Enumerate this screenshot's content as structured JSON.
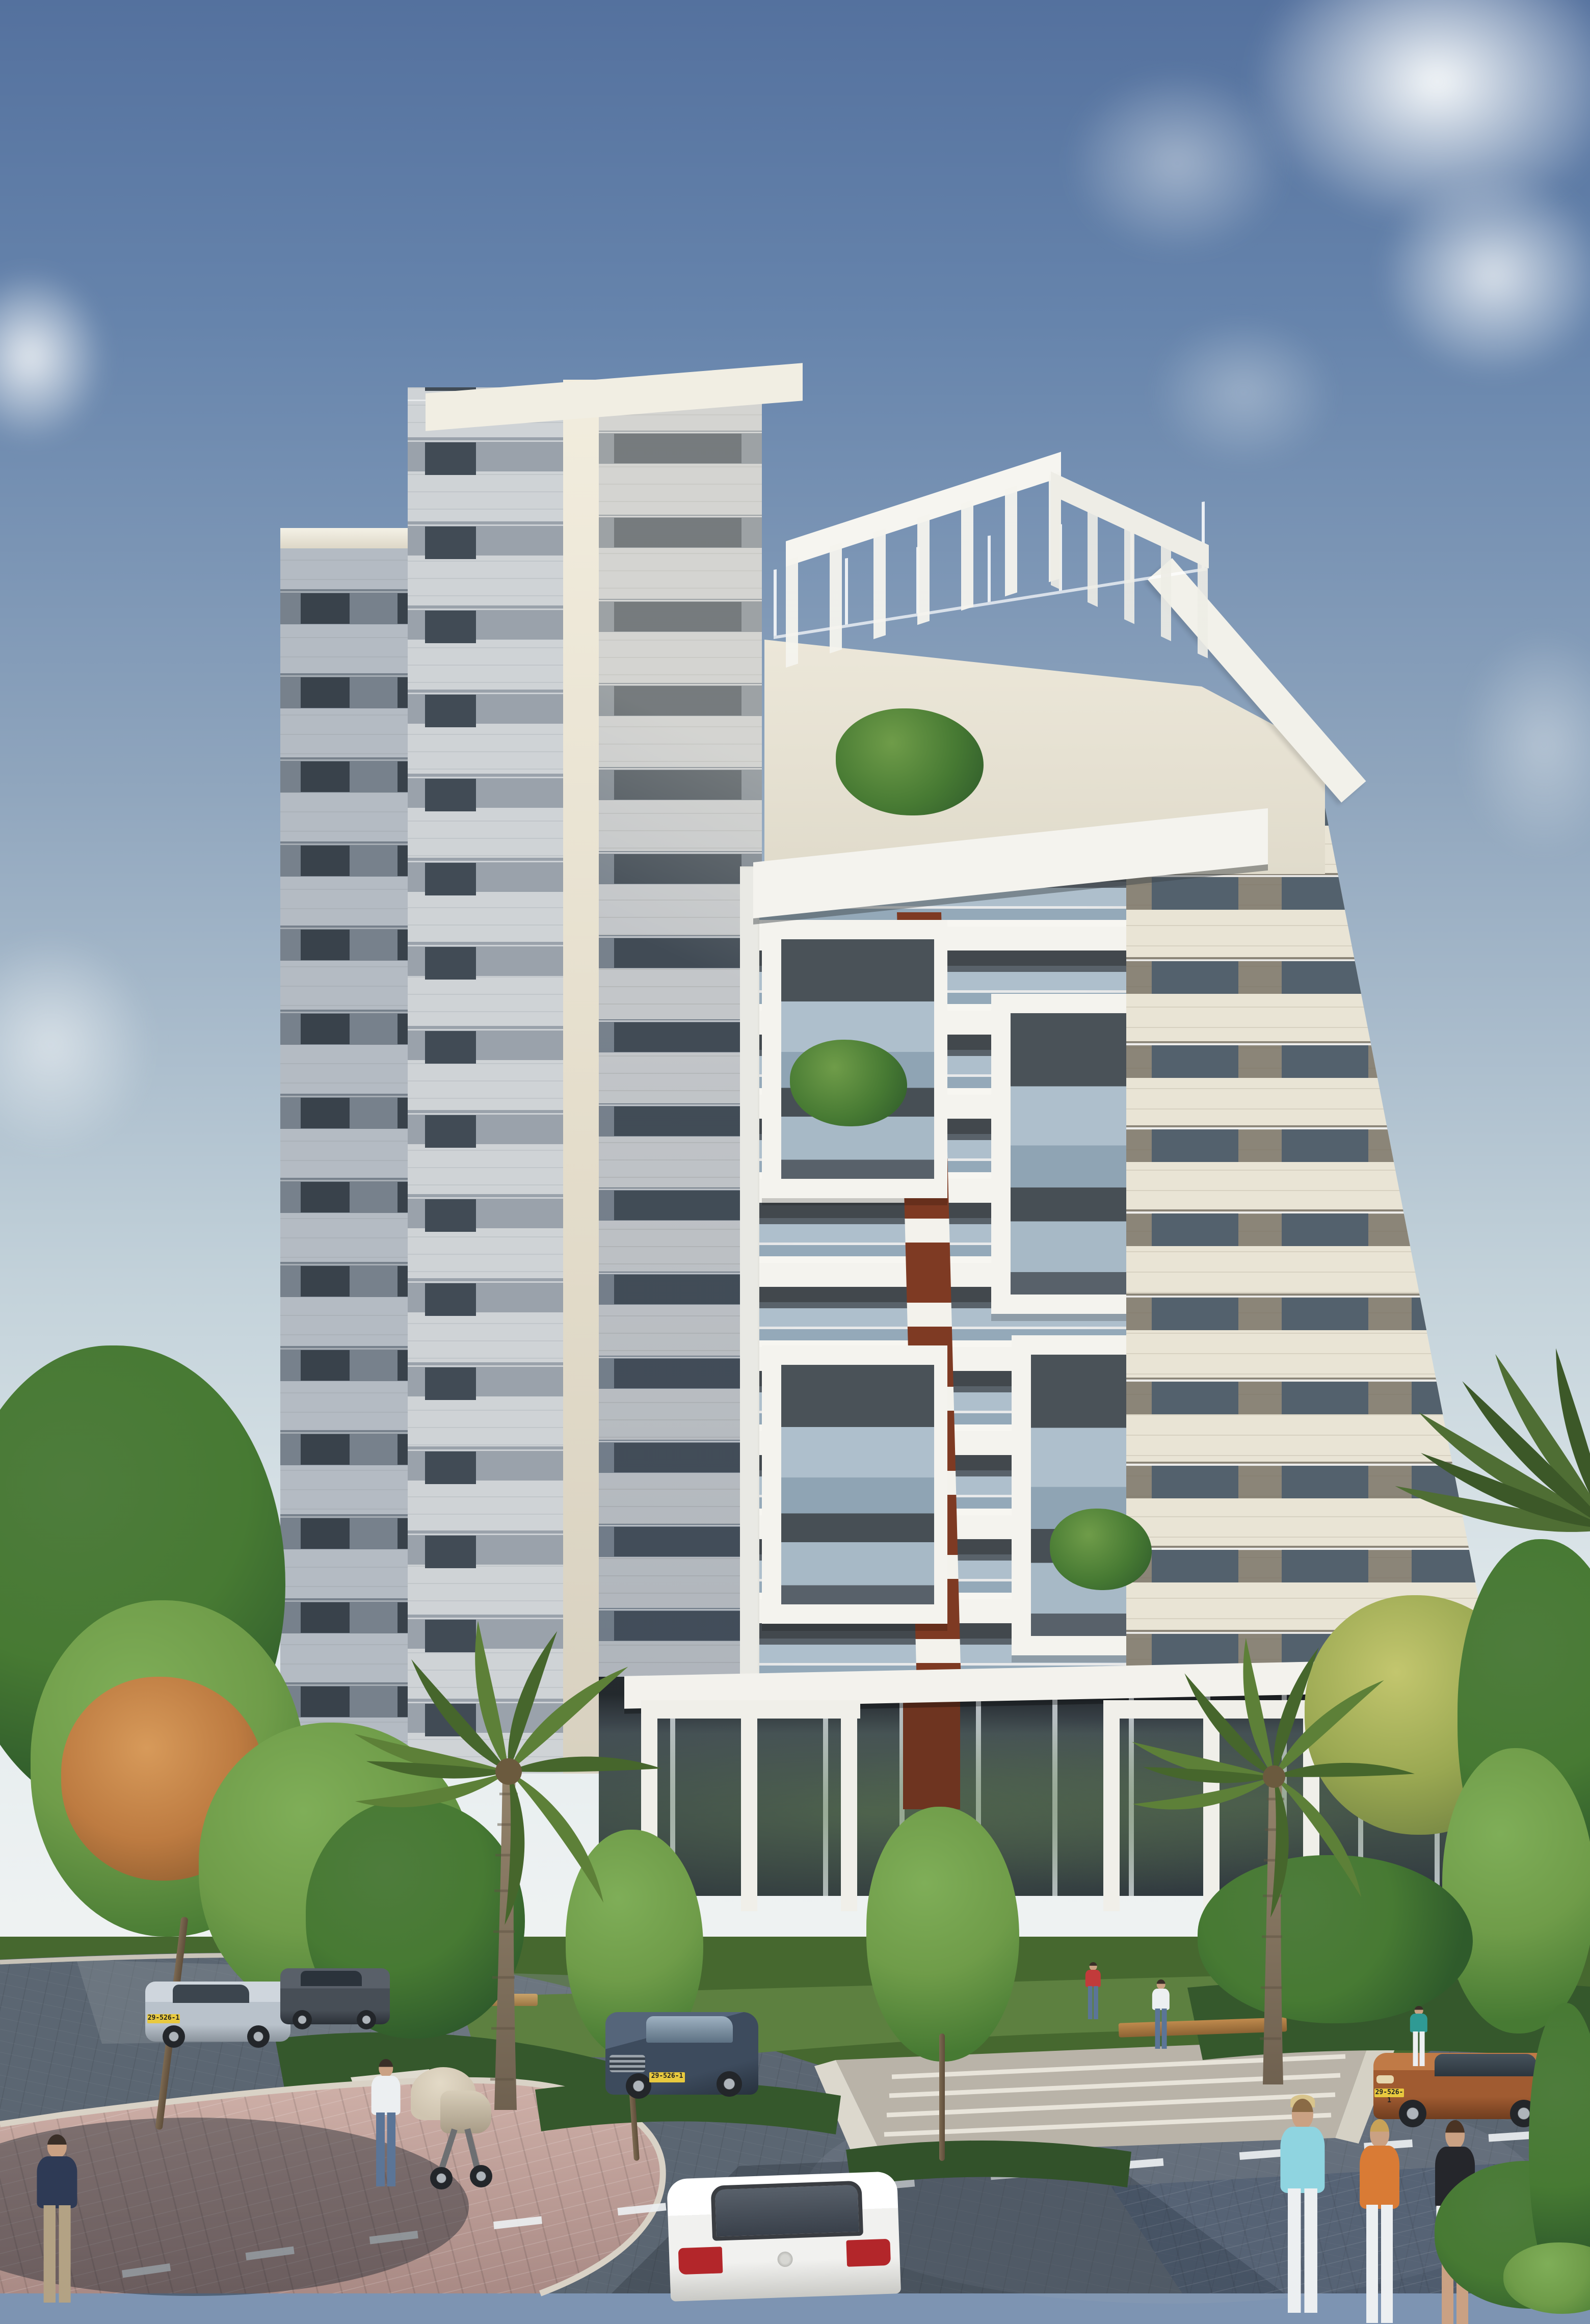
{
  "scene": {
    "type": "architectural-rendering",
    "subject": "Modern residential high-rise apartment tower with stacked white balconies, stone facade and rust-red accent stripe",
    "setting": "Landscaped street corner with paved road, sidewalks, palm trees, parked cars and pedestrians",
    "time_of_day": "daytime, clear blue sky with scattered clouds",
    "license_plate": "29-526-1"
  },
  "colors": {
    "sky_top": "#54719e",
    "sky_upper": "#6684ac",
    "sky_mid": "#8fa5bd",
    "sky_low": "#c3d2da",
    "sky_horizon": "#e6edef",
    "cloud": "#f5f7f7",
    "facade_cream": "#e9e4d5",
    "facade_band_gray": "#8b8578",
    "window_dark": "#53616d",
    "shadow_face": "#c3c6c9",
    "shadow_band": "#77818c",
    "shadow_window": "#414b55",
    "rear_face": "#b4bbc3",
    "rear_window": "#39424b",
    "balcony_white": "#f4f3ee",
    "recess_dark": "#42484d",
    "glass_rail": "#aebfcc",
    "accent_rust": "#7e3a23",
    "road": "#5b6672",
    "sidewalk_pink": "#c5a49c",
    "curb": "#cfc9bd",
    "plaza": "#b9b3a8",
    "step_white": "#e8e4da",
    "grass": "#5d8040",
    "hedge": "#35582c",
    "leaf": "#477a33",
    "leaf_light": "#6f9c49",
    "leaf_dark": "#2f5b2b",
    "leaf_yellow": "#9aa852",
    "leaf_orange": "#bd7b41",
    "palm": "#5d8038",
    "palm_dark": "#46662c",
    "trunk": "#8a7a64",
    "car_white": "#f1f1ef",
    "car_copper": "#a05b31",
    "car_blue": "#3d4b5d",
    "car_silver": "#b9c2cb",
    "car_dark": "#474e56",
    "tail_red": "#b3262a",
    "plate_yellow": "#e8c93e",
    "skin": "#caa183",
    "shirt_navy": "#2e3a55",
    "shirt_teal": "#2f9a94",
    "shirt_lightblue": "#8fd4e0",
    "shirt_orange": "#d97b35",
    "shirt_red": "#c23b3b",
    "white_cloth": "#eceff1",
    "black_cloth": "#25262b",
    "jeans": "#5b7597",
    "khaki": "#b3a284",
    "hair_dark": "#3a2f28",
    "hair_blonde": "#c8a258",
    "stroller_beige": "#cfc4b0"
  }
}
